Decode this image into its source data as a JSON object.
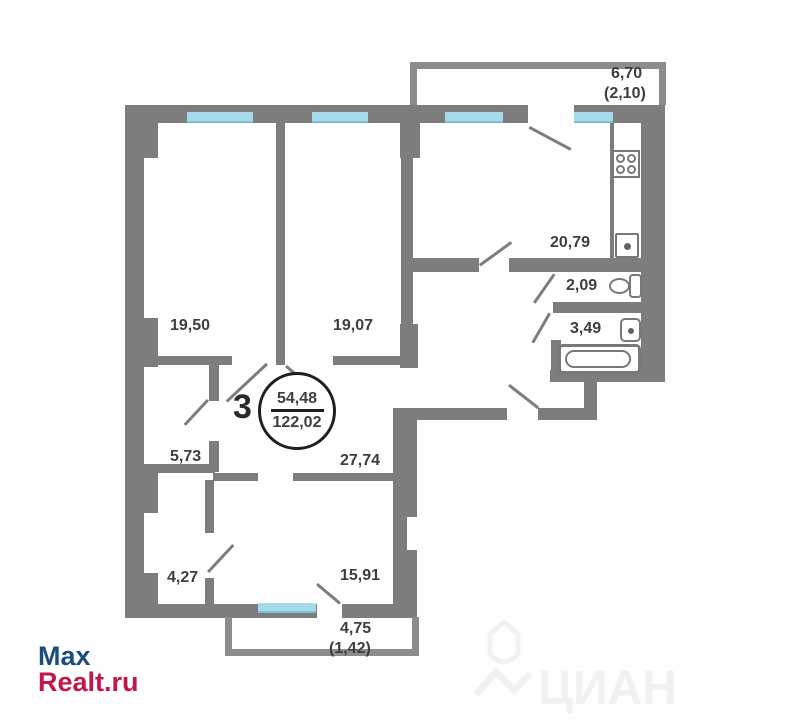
{
  "plan": {
    "unit_number": "3",
    "area_circle": {
      "living_area": "54,48",
      "total_area": "122,02"
    },
    "rooms": [
      {
        "name": "bedroom-1",
        "area": "19,50"
      },
      {
        "name": "bedroom-2",
        "area": "19,07"
      },
      {
        "name": "kitchen",
        "area": "20,79"
      },
      {
        "name": "wc",
        "area": "2,09"
      },
      {
        "name": "bathroom",
        "area": "3,49"
      },
      {
        "name": "hall",
        "area": "27,74"
      },
      {
        "name": "pantry",
        "area": "5,73"
      },
      {
        "name": "wardrobe",
        "area": "4,27"
      },
      {
        "name": "bedroom-3",
        "area": "15,91"
      },
      {
        "name": "loggia-top",
        "area": "6,70",
        "reduced": "(2,10)"
      },
      {
        "name": "loggia-bottom",
        "area": "4,75",
        "reduced": "(1,42)"
      }
    ]
  },
  "watermarks": {
    "agency_line1": "Max",
    "agency_line2": "Realt.ru",
    "portal": "ЦИАН"
  },
  "colors": {
    "wall": "#7d7d7d",
    "balcony_wall": "#8c8c8c",
    "window": "#a7dbe9",
    "label_text": "#3e3e3e",
    "logo_blue": "#1b4e7e",
    "logo_red": "#c2174a",
    "portal_watermark": "#f1f1f1"
  }
}
